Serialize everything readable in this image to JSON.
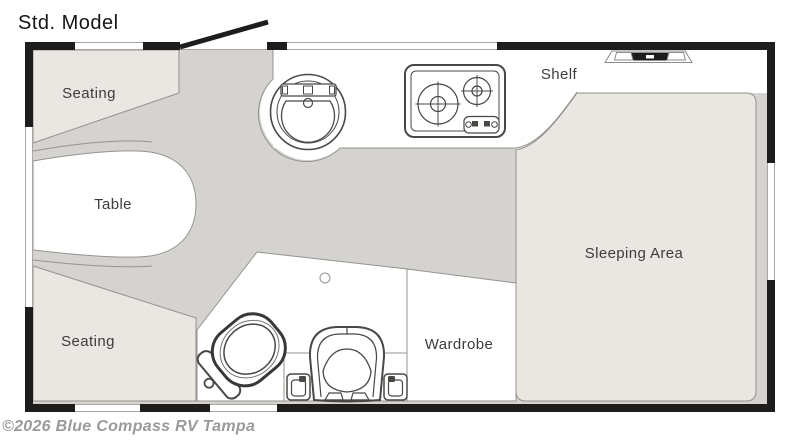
{
  "title": "Std. Model",
  "watermark": "©2026 Blue Compass RV Tampa",
  "rooms": {
    "seating_top": "Seating",
    "table": "Table",
    "seating_bottom": "Seating",
    "shelf": "Shelf",
    "sleeping_area": "Sleeping Area",
    "wardrobe": "Wardrobe"
  },
  "icons": {
    "entry_door": "open-door-swing",
    "roof_vent": "roof-vent",
    "sink": "round-sink-with-faucet",
    "stove": "two-burner-cooktop",
    "toilet": "toilet",
    "seat": "high-back-seat",
    "drain": "floor-drain",
    "boxes": "step-boxes"
  },
  "theme": {
    "wall": "#1e1d1b",
    "floor": "#d5d3cf",
    "furniture": "#eae7e3",
    "fixture": "#ffffff",
    "outline": "#96938e",
    "icon": "#4a4845",
    "label": "#3d3c3a",
    "watermark": "#9c9a98"
  }
}
